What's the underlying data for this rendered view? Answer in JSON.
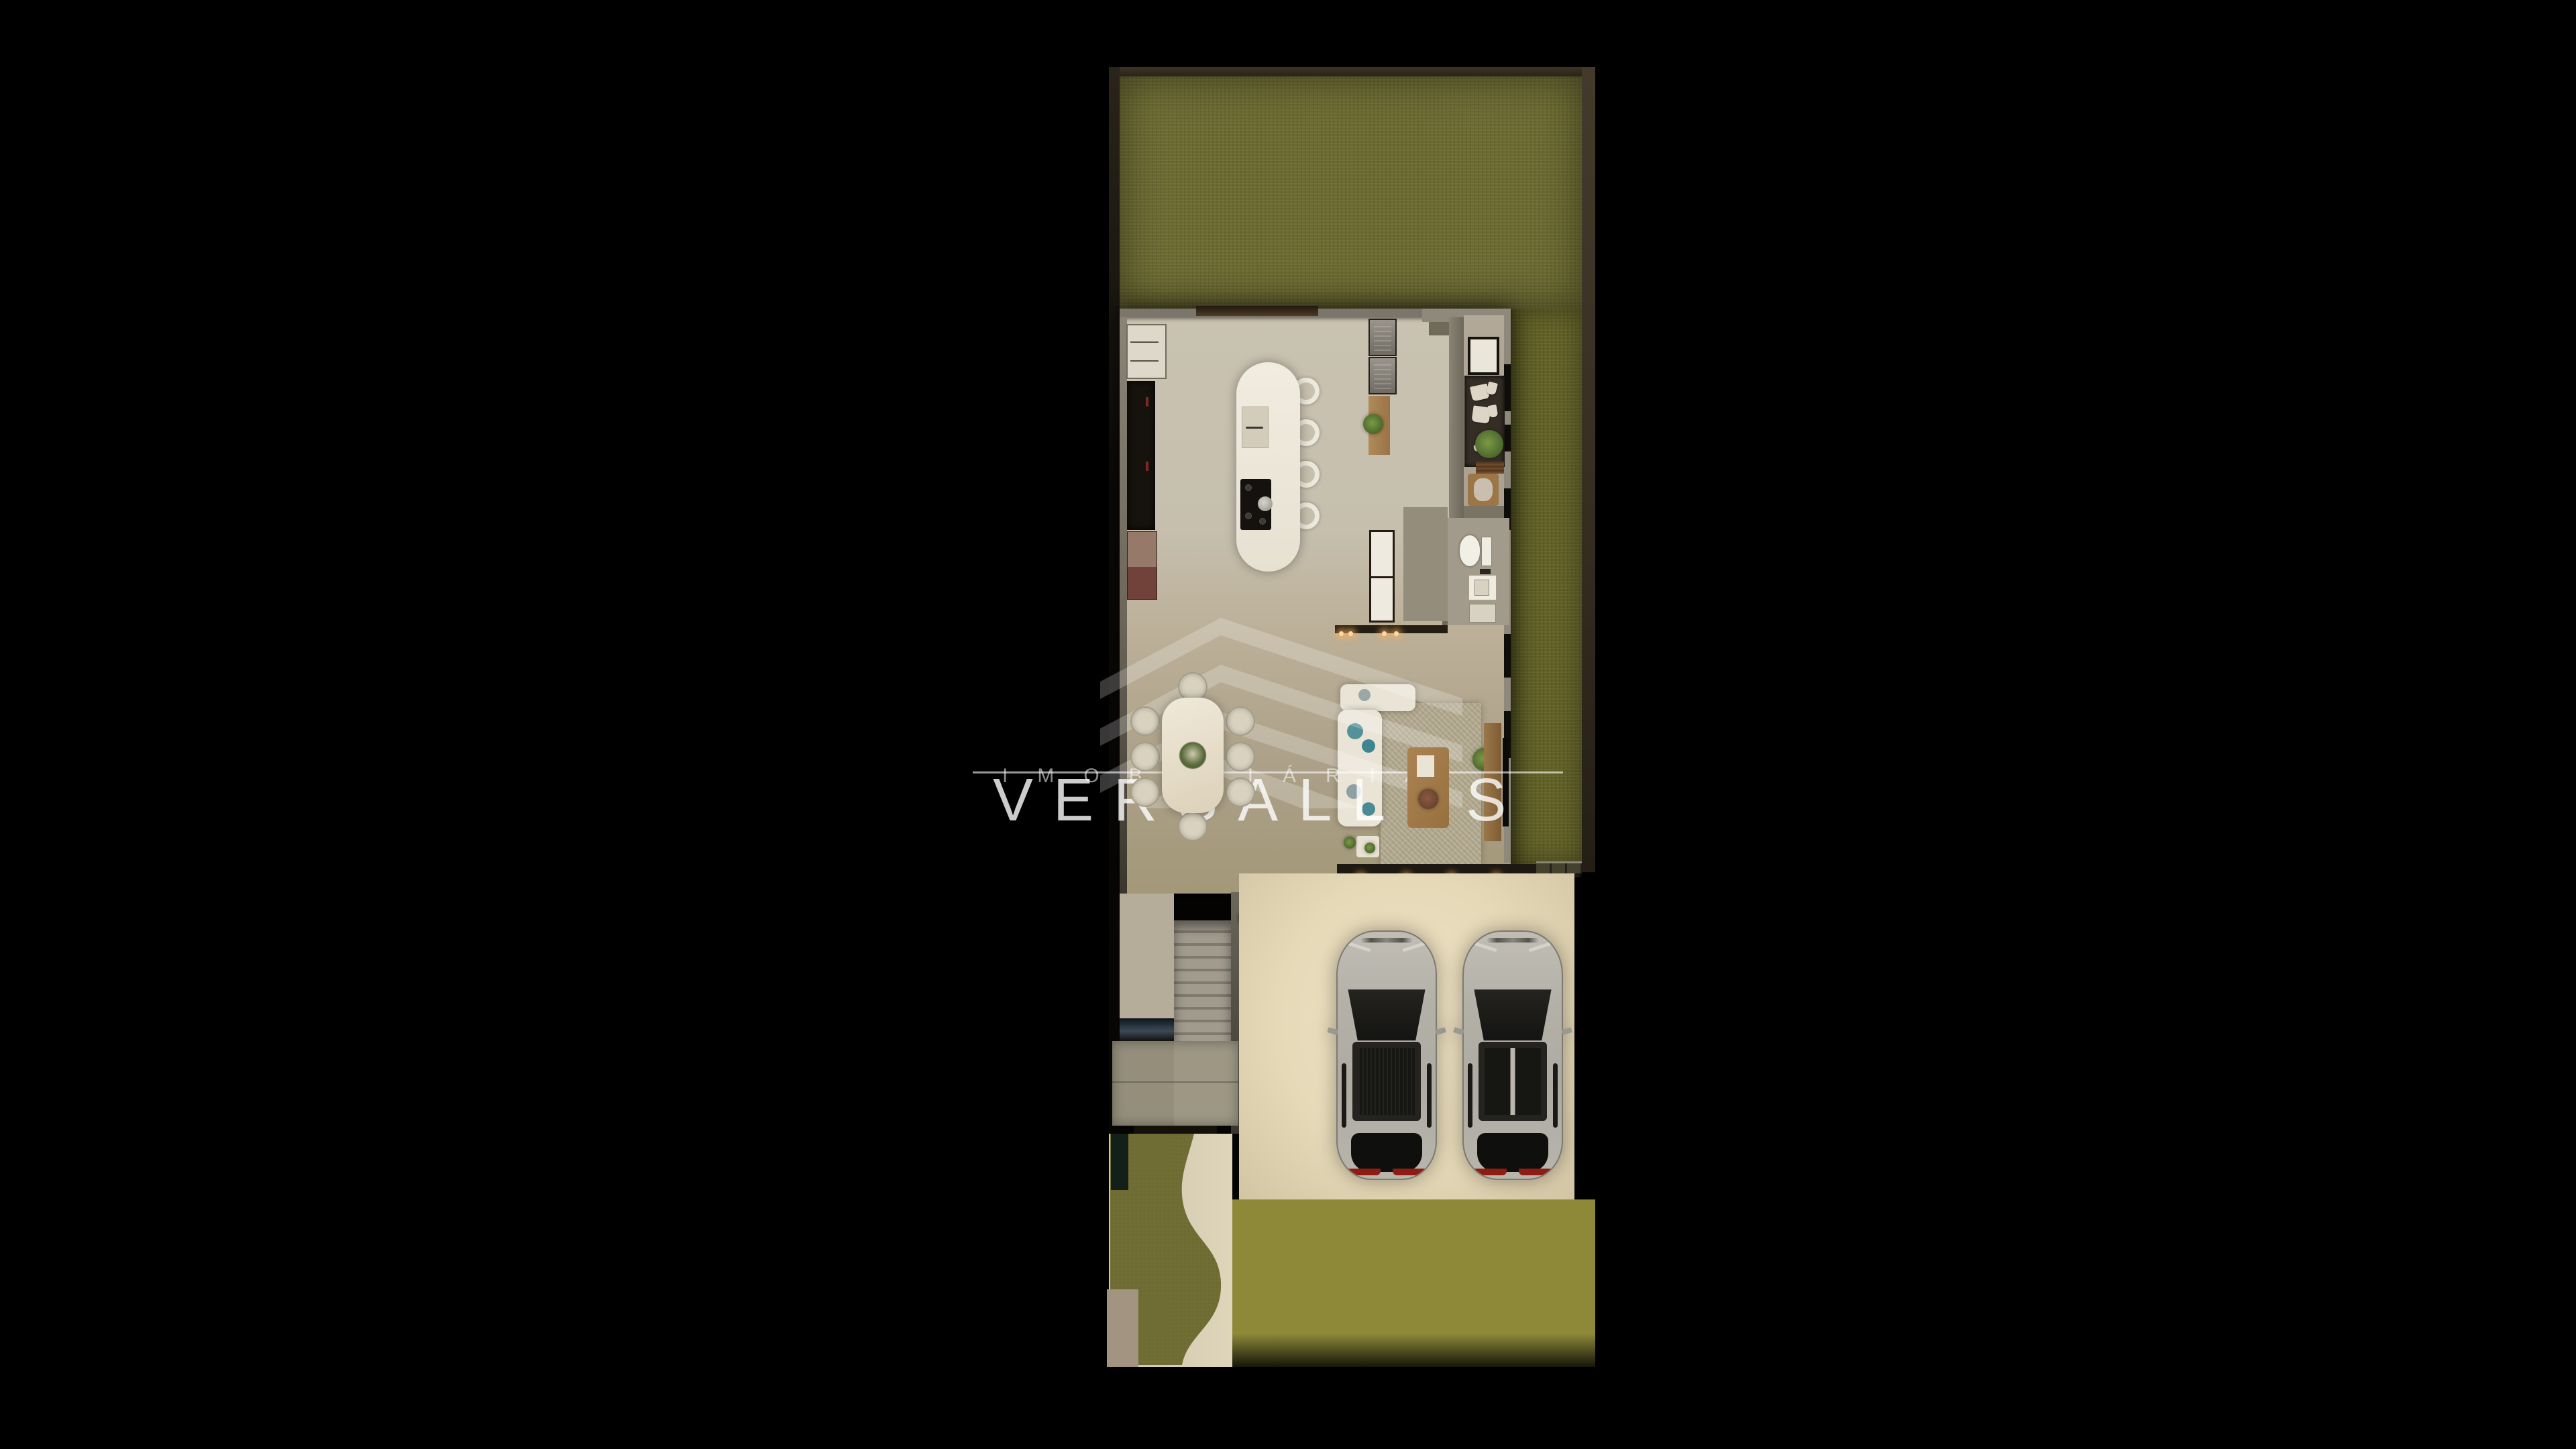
{
  "watermark": {
    "brand_top": "IMOBILIÁRIA",
    "brand_main": "VERSALLES"
  },
  "palette": {
    "background": "#000000",
    "boundary_wall": "#352c1f",
    "grass": "#6c6a32",
    "side-grass": "#626128",
    "kitchen_floor": "#c8c1b0",
    "dining_floor": "#b7ab93",
    "garage_floor": "#e9dfc4",
    "island_white": "#efe9dd",
    "dark_cabinet": "#16120d",
    "wood": "#a8824f",
    "rug": "#b6ac92",
    "joint": "#8d8939",
    "paver": "#716d60",
    "car_body": "#b3b0a8",
    "car_glass": "#161613",
    "taillight": "#8e1c13",
    "accent_plant": "#5a6b3c",
    "light_glow": "#ffd9a2",
    "watermark_white": "#ffffff"
  },
  "regions": [
    {
      "name": "backyard-lawn"
    },
    {
      "name": "kitchen"
    },
    {
      "name": "laundry-corridor"
    },
    {
      "name": "bathroom"
    },
    {
      "name": "dining-room"
    },
    {
      "name": "living-room"
    },
    {
      "name": "staircase"
    },
    {
      "name": "entry-hall"
    },
    {
      "name": "garage",
      "car_count": 2
    },
    {
      "name": "driveway"
    },
    {
      "name": "front-walkway"
    },
    {
      "name": "side-yard"
    }
  ]
}
